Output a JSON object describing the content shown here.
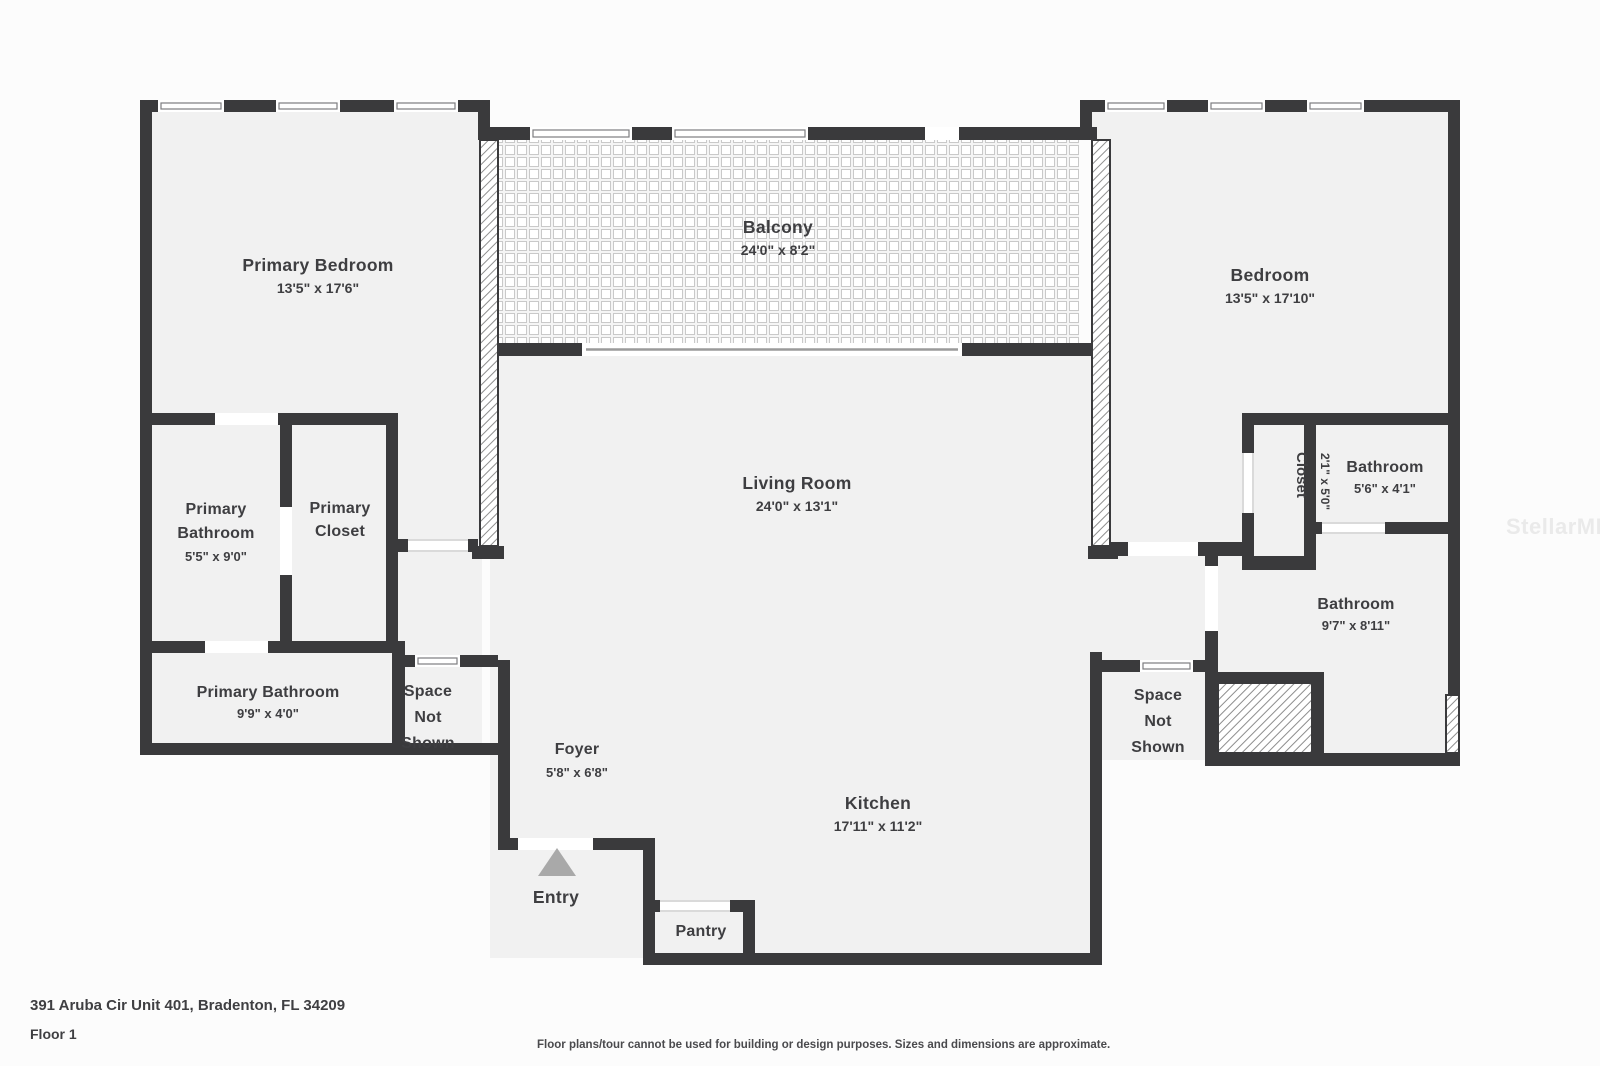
{
  "watermark": "StellarMLS",
  "rooms": {
    "primary_bedroom": {
      "name": "Primary Bedroom",
      "dims": "13'5\" x 17'6\""
    },
    "balcony": {
      "name": "Balcony",
      "dims": "24'0\" x 8'2\""
    },
    "bedroom": {
      "name": "Bedroom",
      "dims": "13'5\" x 17'10\""
    },
    "living_room": {
      "name": "Living Room",
      "dims": "24'0\" x 13'1\""
    },
    "kitchen": {
      "name": "Kitchen",
      "dims": "17'11\" x 11'2\""
    },
    "primary_bathroom": {
      "line1": "Primary",
      "line2": "Bathroom",
      "dims": "5'5\" x 9'0\""
    },
    "primary_closet": {
      "line1": "Primary",
      "line2": "Closet"
    },
    "primary_bathroom_2": {
      "name": "Primary Bathroom",
      "dims": "9'9\" x 4'0\""
    },
    "closet": {
      "name": "Closet",
      "dims": "2'1\" x 5'0\""
    },
    "bathroom_small": {
      "name": "Bathroom",
      "dims": "5'6\" x 4'1\""
    },
    "bathroom_large": {
      "name": "Bathroom",
      "dims": "9'7\" x 8'11\""
    },
    "space_not_shown_left": {
      "line1": "Space",
      "line2": "Not",
      "line3": "Shown"
    },
    "space_not_shown_right": {
      "line1": "Space",
      "line2": "Not",
      "line3": "Shown"
    },
    "foyer": {
      "name": "Foyer",
      "dims": "5'8\" x 6'8\""
    },
    "entry": {
      "name": "Entry"
    },
    "pantry": {
      "name": "Pantry"
    }
  },
  "footer": {
    "address": "391 Aruba Cir Unit 401, Bradenton, FL 34209",
    "floor_label": "Floor 1",
    "disclaimer": "Floor plans/tour cannot be used for building or design purposes. Sizes and dimensions are approximate."
  },
  "colors": {
    "wall": "#3a3a3c",
    "room_fill": "#f1f1f1",
    "background": "#fcfcfc",
    "entry_arrow": "#a9a9a9",
    "watermark_gray": "#eaeaea"
  }
}
